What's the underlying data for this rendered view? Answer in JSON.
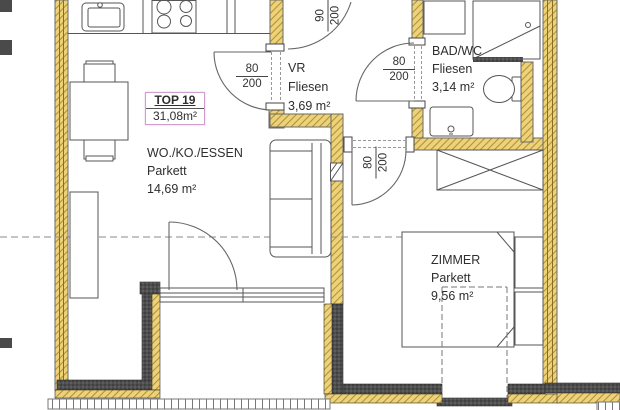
{
  "title_box": {
    "unit": "TOP 19",
    "total_area": "31,08m²"
  },
  "rooms": [
    {
      "key": "living",
      "name": "WO./KO./ESSEN",
      "floor": "Parkett",
      "area": "14,69 m²"
    },
    {
      "key": "vestibule",
      "name": "VR",
      "floor": "Fliesen",
      "area": "3,69 m²"
    },
    {
      "key": "bath",
      "name": "BAD/WC",
      "floor": "Fliesen",
      "area": "3,14 m²"
    },
    {
      "key": "bedroom",
      "name": "ZIMMER",
      "floor": "Parkett",
      "area": "9,56 m²"
    }
  ],
  "door_dimensions": [
    {
      "id": "living-vr",
      "width": "80",
      "height": "200"
    },
    {
      "id": "entrance",
      "width": "90",
      "height": "200"
    },
    {
      "id": "vr-bath",
      "width": "80",
      "height": "200"
    },
    {
      "id": "vr-bedroom",
      "width": "80",
      "height": "200"
    }
  ],
  "colors": {
    "wall_fill": "#ecd27a",
    "wall_hatch": "#b39032",
    "dark_wall": "#4e4e4e",
    "line": "#555555",
    "label_box_border": "#cf9ecf"
  }
}
